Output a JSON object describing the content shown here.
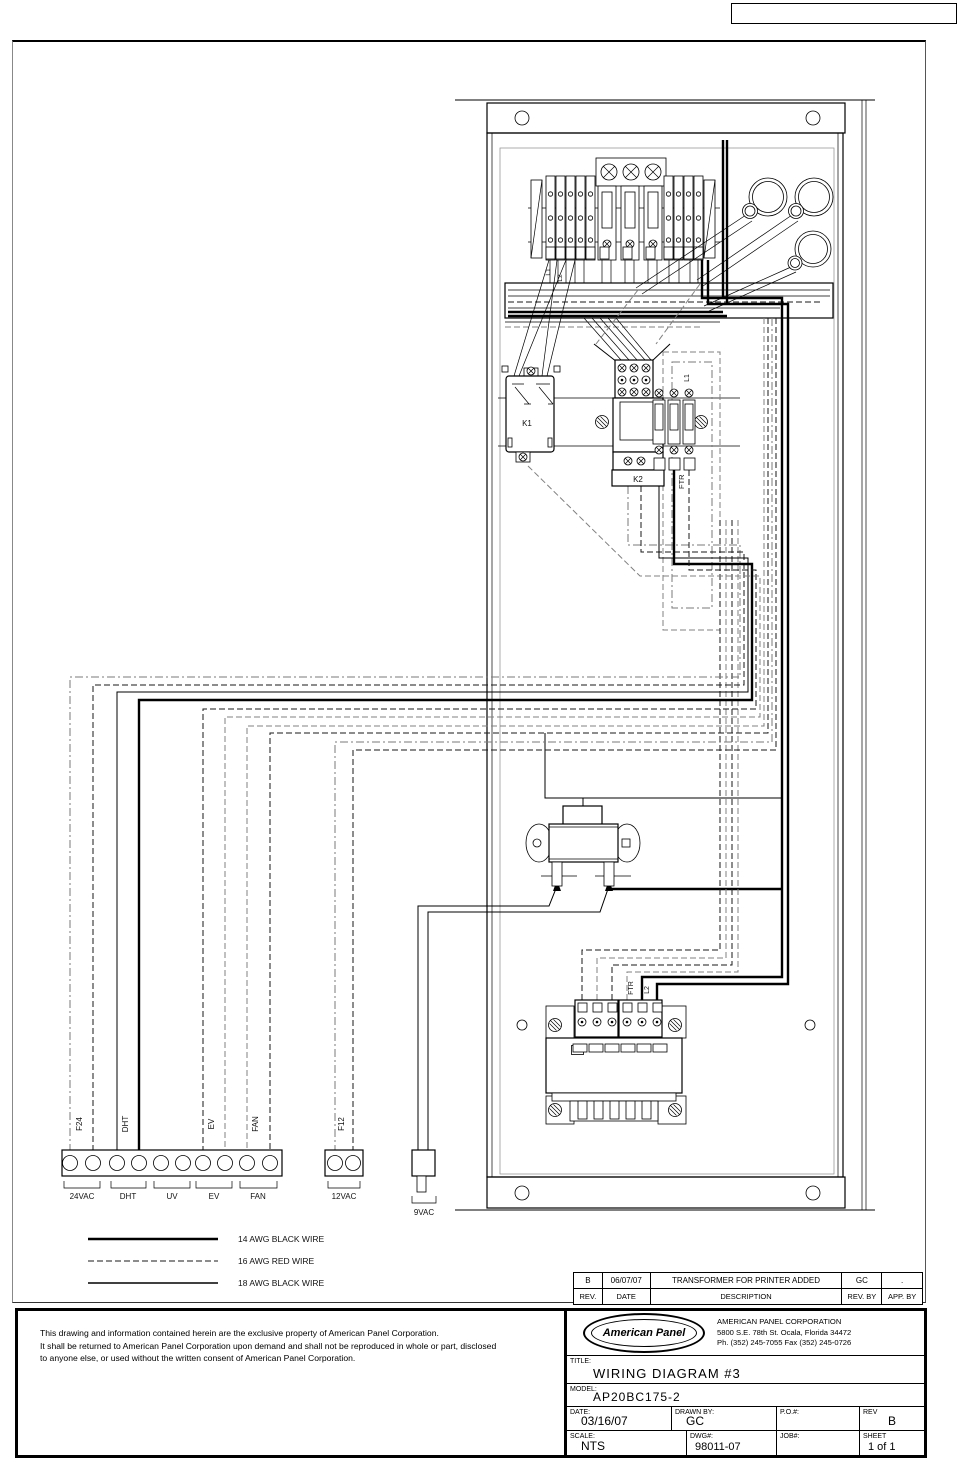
{
  "colors": {
    "line": "#000000",
    "gray_line": "#808080"
  },
  "diagram": {
    "components": {
      "k1": "K1",
      "k2": "K2",
      "ftr": "FTR"
    },
    "wire_flags": {
      "strip_l1": "L1",
      "strip_l2": "L2",
      "ftr_top_l1": "L1",
      "t2_ftr": "FTR",
      "t2_l2": "L2"
    },
    "bottom_terminals": {
      "wire_labels": [
        "F24",
        "DHT",
        "EV",
        "FAN",
        "F12"
      ],
      "group_labels": [
        "24VAC",
        "DHT",
        "UV",
        "EV",
        "FAN"
      ],
      "strip2_label": "12VAC",
      "plug_label": "9VAC"
    },
    "legend": [
      {
        "label": "14 AWG BLACK WIRE",
        "style": "solid-thick"
      },
      {
        "label": "16 AWG RED WIRE",
        "style": "dashed"
      },
      {
        "label": "18 AWG BLACK WIRE",
        "style": "solid-thin"
      }
    ]
  },
  "revision_table": {
    "headers": {
      "rev": "REV.",
      "date": "DATE",
      "description": "DESCRIPTION",
      "rev_by": "REV. BY",
      "app_by": "APP. BY"
    },
    "rows": [
      {
        "rev": "B",
        "date": "06/07/07",
        "description": "TRANSFORMER FOR PRINTER ADDED",
        "rev_by": "GC",
        "app_by": "."
      }
    ]
  },
  "disclaimer": {
    "line1": "This drawing and information contained herein are the exclusive property of American Panel Corporation.",
    "line2": "It shall be returned to American Panel Corporation upon demand and shall not be reproduced in whole or part, disclosed",
    "line3": "to anyone else, or used without the written consent of American Panel Corporation."
  },
  "title_block": {
    "logo_text": "American Panel",
    "company": "AMERICAN PANEL CORPORATION",
    "address": "5800 S.E. 78th St. Ocala, Florida 34472",
    "phone_fax": "Ph. (352) 245-7055   Fax (352) 245-0726",
    "title_label": "TITLE:",
    "title": "WIRING DIAGRAM #3",
    "model_label": "MODEL:",
    "model": "AP20BC175-2",
    "date_label": "DATE:",
    "date": "03/16/07",
    "drawn_by_label": "DRAWN BY:",
    "drawn_by": "GC",
    "po_label": "P.O.#:",
    "po": "",
    "rev_label": "REV",
    "rev": "B",
    "scale_label": "SCALE:",
    "scale": "NTS",
    "dwg_label": "DWG#:",
    "dwg": "98011-07",
    "job_label": "JOB#:",
    "job": "",
    "sheet_label": "SHEET",
    "sheet": "1 of 1"
  }
}
